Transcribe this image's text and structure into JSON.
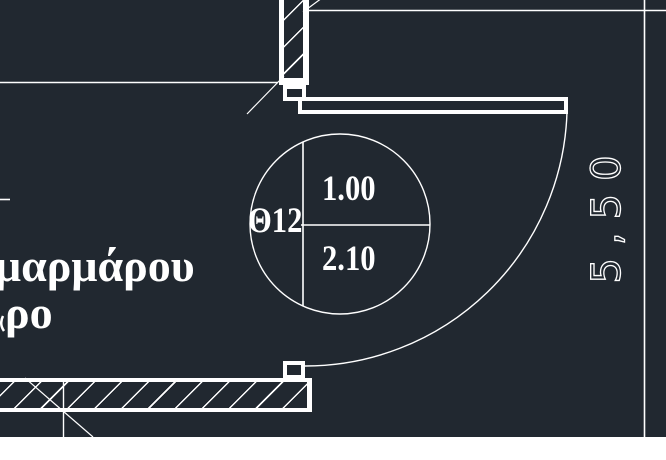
{
  "canvas": {
    "background": "#212830",
    "line_color": "#ffffff"
  },
  "labels": {
    "room_material_line1": "μαρμάρου",
    "room_material_line2": "ρο"
  },
  "door_tag": {
    "code": "Θ12",
    "width": "1.00",
    "height": "2.10"
  },
  "dimension": {
    "length": "5,50"
  }
}
